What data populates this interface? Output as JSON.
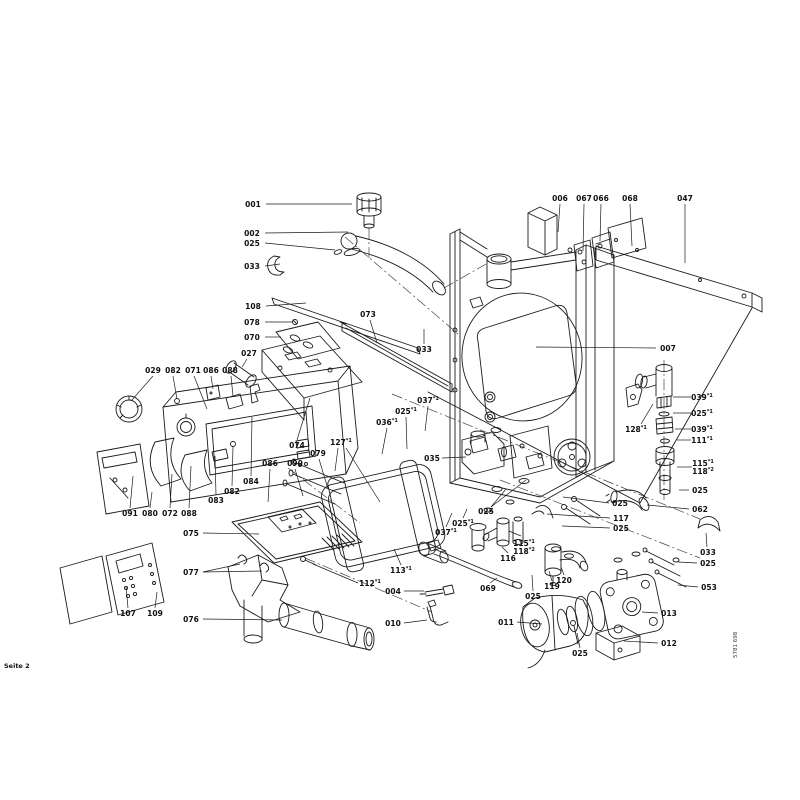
{
  "page": {
    "footer_left": "Seite 2",
    "vertical_code": "5781 698"
  },
  "colors": {
    "background": "#ffffff",
    "ink": "#1b1b1b"
  },
  "diagram": {
    "description": "exploded-parts-diagram",
    "labels": [
      {
        "text": "001",
        "x": 253,
        "y": 207,
        "leaders": [
          [
            266,
            204,
            352,
            204
          ]
        ]
      },
      {
        "text": "002",
        "x": 252,
        "y": 236,
        "leaders": [
          [
            265,
            233,
            348,
            232
          ]
        ]
      },
      {
        "text": "025",
        "x": 252,
        "y": 246,
        "leaders": [
          [
            265,
            243,
            335,
            250
          ]
        ]
      },
      {
        "text": "033",
        "x": 252,
        "y": 269,
        "leaders": [
          [
            265,
            266,
            280,
            264
          ]
        ]
      },
      {
        "text": "108",
        "x": 253,
        "y": 309,
        "leaders": [
          [
            266,
            306,
            306,
            303
          ]
        ]
      },
      {
        "text": "078",
        "x": 252,
        "y": 325,
        "leaders": [
          [
            265,
            322,
            293,
            322
          ]
        ]
      },
      {
        "text": "070",
        "x": 252,
        "y": 340,
        "leaders": [
          [
            265,
            337,
            281,
            337
          ]
        ]
      },
      {
        "text": "027",
        "x": 249,
        "y": 356,
        "leaders": [
          [
            247,
            359,
            242,
            367
          ]
        ]
      },
      {
        "text": "073",
        "x": 368,
        "y": 317,
        "leaders": [
          [
            370,
            320,
            377,
            343
          ]
        ]
      },
      {
        "text": "033",
        "x": 424,
        "y": 352,
        "leaders": [
          [
            424,
            344,
            424,
            329
          ]
        ]
      },
      {
        "text": "006",
        "x": 560,
        "y": 201,
        "leaders": [
          [
            560,
            204,
            558,
            232
          ]
        ]
      },
      {
        "text": "067",
        "x": 584,
        "y": 201,
        "leaders": [
          [
            584,
            204,
            583,
            251
          ]
        ]
      },
      {
        "text": "066",
        "x": 601,
        "y": 201,
        "leaders": [
          [
            601,
            204,
            600,
            241
          ]
        ]
      },
      {
        "text": "068",
        "x": 630,
        "y": 201,
        "leaders": [
          [
            630,
            204,
            632,
            246
          ]
        ]
      },
      {
        "text": "047",
        "x": 685,
        "y": 201,
        "leaders": [
          [
            685,
            204,
            685,
            263
          ]
        ]
      },
      {
        "text": "007",
        "x": 668,
        "y": 351,
        "leaders": [
          [
            656,
            348,
            536,
            347
          ]
        ]
      },
      {
        "text": "029",
        "x": 153,
        "y": 373,
        "leaders": [
          [
            153,
            376,
            131,
            401
          ]
        ]
      },
      {
        "text": "082",
        "x": 173,
        "y": 373,
        "leaders": [
          [
            173,
            376,
            177,
            399
          ]
        ]
      },
      {
        "text": "071",
        "x": 193,
        "y": 373,
        "leaders": [
          [
            194,
            376,
            207,
            409
          ]
        ]
      },
      {
        "text": "086",
        "x": 211,
        "y": 373,
        "leaders": [
          [
            211,
            376,
            213,
            389
          ]
        ]
      },
      {
        "text": "088",
        "x": 230,
        "y": 373,
        "leaders": [
          [
            231,
            376,
            233,
            396
          ]
        ]
      },
      {
        "text": "091",
        "x": 130,
        "y": 516,
        "leaders": [
          [
            130,
            508,
            133,
            476
          ]
        ]
      },
      {
        "text": "080",
        "x": 150,
        "y": 516,
        "leaders": [
          [
            150,
            508,
            152,
            492
          ]
        ]
      },
      {
        "text": "072",
        "x": 170,
        "y": 516,
        "leaders": [
          [
            170,
            508,
            172,
            474
          ]
        ]
      },
      {
        "text": "088",
        "x": 189,
        "y": 516,
        "leaders": [
          [
            189,
            508,
            191,
            466
          ]
        ]
      },
      {
        "text": "083",
        "x": 216,
        "y": 503,
        "leaders": [
          [
            216,
            495,
            215,
            456
          ]
        ]
      },
      {
        "text": "082",
        "x": 232,
        "y": 494,
        "leaders": [
          [
            232,
            486,
            233,
            446
          ]
        ]
      },
      {
        "text": "084",
        "x": 251,
        "y": 484,
        "leaders": [
          [
            251,
            476,
            252,
            417
          ]
        ]
      },
      {
        "text": "086",
        "x": 270,
        "y": 466,
        "leaders": [
          [
            270,
            469,
            268,
            502
          ]
        ]
      },
      {
        "text": "074",
        "x": 297,
        "y": 448,
        "leaders": [
          [
            297,
            440,
            310,
            398
          ]
        ]
      },
      {
        "text": "090",
        "x": 295,
        "y": 466,
        "leaders": [
          [
            295,
            469,
            303,
            496
          ]
        ]
      },
      {
        "text": "079",
        "x": 318,
        "y": 456,
        "leaders": [
          [
            319,
            459,
            328,
            489
          ]
        ]
      },
      {
        "text": "127*1",
        "x": 341,
        "y": 445,
        "leaders": [
          [
            338,
            448,
            335,
            471
          ],
          [
            346,
            448,
            380,
            502
          ]
        ]
      },
      {
        "text": "036*1",
        "x": 387,
        "y": 425,
        "leaders": [
          [
            387,
            428,
            382,
            454
          ]
        ]
      },
      {
        "text": "025*1",
        "x": 406,
        "y": 414,
        "leaders": [
          [
            406,
            417,
            407,
            449
          ]
        ]
      },
      {
        "text": "037*1",
        "x": 428,
        "y": 403,
        "leaders": [
          [
            428,
            406,
            425,
            431
          ]
        ]
      },
      {
        "text": "035",
        "x": 432,
        "y": 461,
        "leaders": [
          [
            442,
            458,
            466,
            457
          ]
        ]
      },
      {
        "text": "039*1",
        "x": 702,
        "y": 400,
        "anchor": "middle",
        "leaders": [
          [
            691,
            397,
            673,
            397
          ]
        ]
      },
      {
        "text": "025*1",
        "x": 702,
        "y": 416,
        "leaders": [
          [
            691,
            413,
            673,
            413
          ]
        ]
      },
      {
        "text": "039*1",
        "x": 702,
        "y": 432,
        "leaders": [
          [
            691,
            429,
            675,
            429
          ]
        ]
      },
      {
        "text": "111*1",
        "x": 702,
        "y": 443,
        "leaders": [
          [
            691,
            440,
            677,
            440
          ]
        ]
      },
      {
        "text": "115*1",
        "text2": "118*2",
        "x": 703,
        "y": 466,
        "leaders": [
          [
            692,
            467,
            677,
            467
          ]
        ]
      },
      {
        "text": "025",
        "x": 700,
        "y": 493,
        "leaders": [
          [
            689,
            490,
            679,
            490
          ]
        ]
      },
      {
        "text": "128*1",
        "x": 636,
        "y": 432,
        "leaders": [
          [
            641,
            424,
            653,
            404
          ]
        ]
      },
      {
        "text": "025",
        "x": 620,
        "y": 506,
        "leaders": [
          [
            609,
            503,
            563,
            497
          ]
        ]
      },
      {
        "text": "117",
        "x": 621,
        "y": 521,
        "leaders": [
          [
            610,
            518,
            547,
            514
          ]
        ]
      },
      {
        "text": "025",
        "x": 621,
        "y": 531,
        "leaders": [
          [
            610,
            528,
            562,
            526
          ]
        ]
      },
      {
        "text": "062",
        "x": 700,
        "y": 512,
        "leaders": [
          [
            689,
            509,
            647,
            505
          ]
        ]
      },
      {
        "text": "033",
        "x": 708,
        "y": 555,
        "leaders": [
          [
            707,
            547,
            706,
            533
          ]
        ]
      },
      {
        "text": "025",
        "x": 708,
        "y": 566,
        "leaders": [
          [
            697,
            563,
            678,
            562
          ]
        ]
      },
      {
        "text": "053",
        "x": 709,
        "y": 590,
        "leaders": [
          [
            698,
            587,
            678,
            585
          ]
        ]
      },
      {
        "text": "013",
        "x": 669,
        "y": 616,
        "leaders": [
          [
            658,
            613,
            642,
            612
          ]
        ]
      },
      {
        "text": "012",
        "x": 669,
        "y": 646,
        "leaders": [
          [
            658,
            643,
            624,
            641
          ]
        ]
      },
      {
        "text": "011",
        "x": 506,
        "y": 625,
        "leaders": [
          [
            517,
            622,
            542,
            624
          ]
        ]
      },
      {
        "text": "025",
        "x": 533,
        "y": 599,
        "leaders": [
          [
            533,
            591,
            532,
            575
          ]
        ]
      },
      {
        "text": "025",
        "x": 580,
        "y": 656,
        "leaders": [
          [
            580,
            648,
            577,
            633
          ]
        ]
      },
      {
        "text": "119",
        "x": 552,
        "y": 589,
        "leaders": [
          [
            552,
            581,
            549,
            571
          ]
        ]
      },
      {
        "text": "120",
        "x": 564,
        "y": 583,
        "leaders": [
          [
            564,
            575,
            561,
            567
          ]
        ]
      },
      {
        "text": "116",
        "x": 508,
        "y": 561,
        "leaders": [
          [
            508,
            553,
            502,
            547
          ]
        ]
      },
      {
        "text": "115*1",
        "text2": "118*2",
        "x": 524,
        "y": 546,
        "leaders": [
          [
            521,
            536,
            509,
            531
          ]
        ]
      },
      {
        "text": "069",
        "x": 488,
        "y": 591,
        "leaders": [
          [
            490,
            583,
            497,
            578
          ]
        ]
      },
      {
        "text": "004",
        "x": 393,
        "y": 594,
        "leaders": [
          [
            404,
            591,
            424,
            591
          ]
        ]
      },
      {
        "text": "010",
        "x": 393,
        "y": 626,
        "leaders": [
          [
            404,
            623,
            427,
            620
          ]
        ]
      },
      {
        "text": "113*1",
        "x": 401,
        "y": 573,
        "leaders": [
          [
            401,
            565,
            394,
            549
          ]
        ]
      },
      {
        "text": "112*1",
        "x": 370,
        "y": 586,
        "leaders": [
          [
            358,
            583,
            313,
            564
          ]
        ]
      },
      {
        "text": "037*1",
        "x": 446,
        "y": 535,
        "leaders": [
          [
            446,
            527,
            452,
            513
          ]
        ]
      },
      {
        "text": "025*1",
        "x": 463,
        "y": 526,
        "leaders": [
          [
            463,
            518,
            467,
            509
          ]
        ]
      },
      {
        "text": "025",
        "x": 486,
        "y": 514,
        "leaders": [
          [
            491,
            507,
            506,
            489
          ],
          [
            491,
            507,
            526,
            480
          ]
        ]
      },
      {
        "text": "075",
        "x": 191,
        "y": 536,
        "leaders": [
          [
            203,
            533,
            259,
            534
          ]
        ]
      },
      {
        "text": "077",
        "x": 191,
        "y": 575,
        "leaders": [
          [
            203,
            572,
            240,
            564
          ],
          [
            203,
            572,
            262,
            571
          ]
        ]
      },
      {
        "text": "076",
        "x": 191,
        "y": 622,
        "leaders": [
          [
            203,
            619,
            282,
            620
          ]
        ]
      },
      {
        "text": "107",
        "x": 128,
        "y": 616,
        "leaders": [
          [
            128,
            608,
            126,
            586
          ]
        ]
      },
      {
        "text": "109",
        "x": 155,
        "y": 616,
        "leaders": [
          [
            155,
            608,
            157,
            592
          ]
        ]
      }
    ]
  }
}
